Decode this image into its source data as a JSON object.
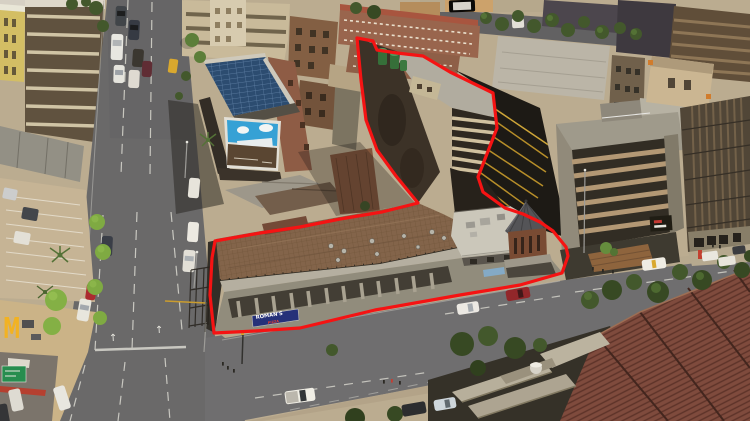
{
  "scene": {
    "type": "aerial-drone-photograph",
    "description": "Oblique aerial view of an urban corner property outlined in red at a road intersection, surrounded by office and apartment blocks, street trees, parked and moving cars, a McDonald's corner lot, a solar-panel roof with a blue billboard, and a large red ribbed roof at bottom right",
    "time_of_day": "midday"
  },
  "property_outline": {
    "color": "#f51313",
    "stroke_width": 3.2,
    "points": "357,38 373,41 377,50 397,53 423,56 450,72 493,93 497,128 478,177 483,192 505,208 523,214 540,222 553,231 566,247 568,256 562,273 520,285 460,295 375,310 300,328 255,331 214,333 210,295 212,258 215,241 260,233 300,227 340,219 382,212 418,203 396,176 377,150 366,120 361,80"
  },
  "signs": {
    "romans_pizza": {
      "line1": "ROMAN'S",
      "line2": "PIZZA"
    },
    "mcdonalds": {
      "glyph": "M"
    }
  },
  "road": {
    "lane_arrow": "↑"
  },
  "palette": {
    "road": "#646468",
    "ground": "#b9aa90",
    "sidewalk": "#c2b49a",
    "property_roof_brown": "#7e5f47",
    "red_tile_roof": "#7a453a",
    "solar_panel_blue": "#24466f",
    "billboard_blue": "#2e9fd8",
    "romans_sign_blue": "#1e2a78",
    "mcdonalds_yellow": "#f2b01e",
    "highway_sign_green": "#1f8a4c",
    "tree_green": "#567a36",
    "outline_red": "#f51313"
  }
}
